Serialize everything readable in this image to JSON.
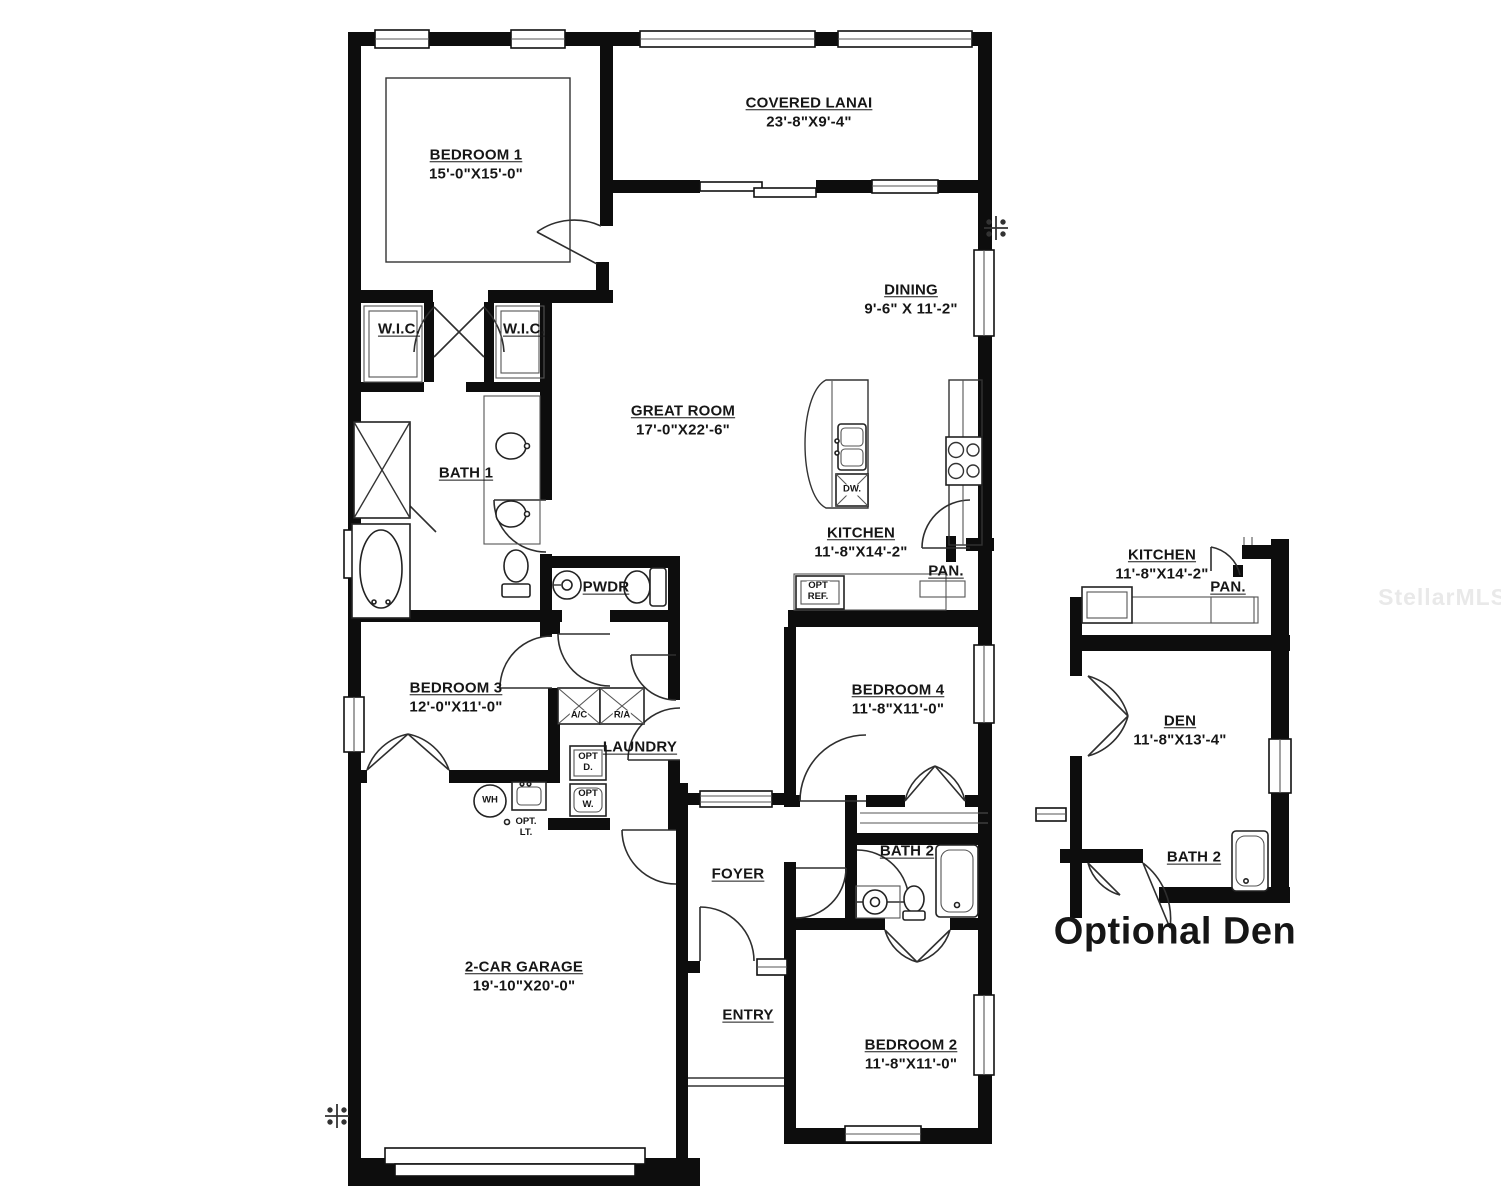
{
  "plan": {
    "watermark": "StellarMLS",
    "rooms": {
      "bedroom1": {
        "name": "BEDROOM 1",
        "dims": "15'-0\"X15'-0\""
      },
      "covered_lanai": {
        "name": "COVERED LANAI",
        "dims": "23'-8\"X9'-4\""
      },
      "dining": {
        "name": "DINING",
        "dims": "9'-6\" X 11'-2\""
      },
      "great_room": {
        "name": "GREAT ROOM",
        "dims": "17'-0\"X22'-6\""
      },
      "kitchen": {
        "name": "KITCHEN",
        "dims": "11'-8\"X14'-2\""
      },
      "pantry": {
        "name": "PAN."
      },
      "wic_left": {
        "name": "W.I.C."
      },
      "wic_right": {
        "name": "W.I.C."
      },
      "bath1": {
        "name": "BATH 1"
      },
      "powder": {
        "name": "PWDR"
      },
      "bedroom3": {
        "name": "BEDROOM 3",
        "dims": "12'-0\"X11'-0\""
      },
      "laundry": {
        "name": "LAUNDRY"
      },
      "foyer": {
        "name": "FOYER"
      },
      "entry": {
        "name": "ENTRY"
      },
      "garage": {
        "name": "2-CAR GARAGE",
        "dims": "19'-10\"X20'-0\""
      },
      "bedroom4": {
        "name": "BEDROOM 4",
        "dims": "11'-8\"X11'-0\""
      },
      "bath2": {
        "name": "BATH 2"
      },
      "bedroom2": {
        "name": "BEDROOM 2",
        "dims": "11'-8\"X11'-0\""
      }
    },
    "fixtures": {
      "dw": "DW.",
      "opt_ref_1": "OPT",
      "opt_ref_2": "REF.",
      "ac": "A/C",
      "ra": "R/A",
      "opt_d_1": "OPT",
      "opt_d_2": "D.",
      "opt_w_1": "OPT",
      "opt_w_2": "W.",
      "wh": "WH",
      "opt_lt_1": "OPT.",
      "opt_lt_2": "LT."
    },
    "inset": {
      "title": "Optional Den",
      "kitchen": {
        "name": "KITCHEN",
        "dims": "11'-8\"X14'-2\""
      },
      "pantry": {
        "name": "PAN."
      },
      "den": {
        "name": "DEN",
        "dims": "11'-8\"X13'-4\""
      },
      "bath2": {
        "name": "BATH 2"
      }
    }
  }
}
